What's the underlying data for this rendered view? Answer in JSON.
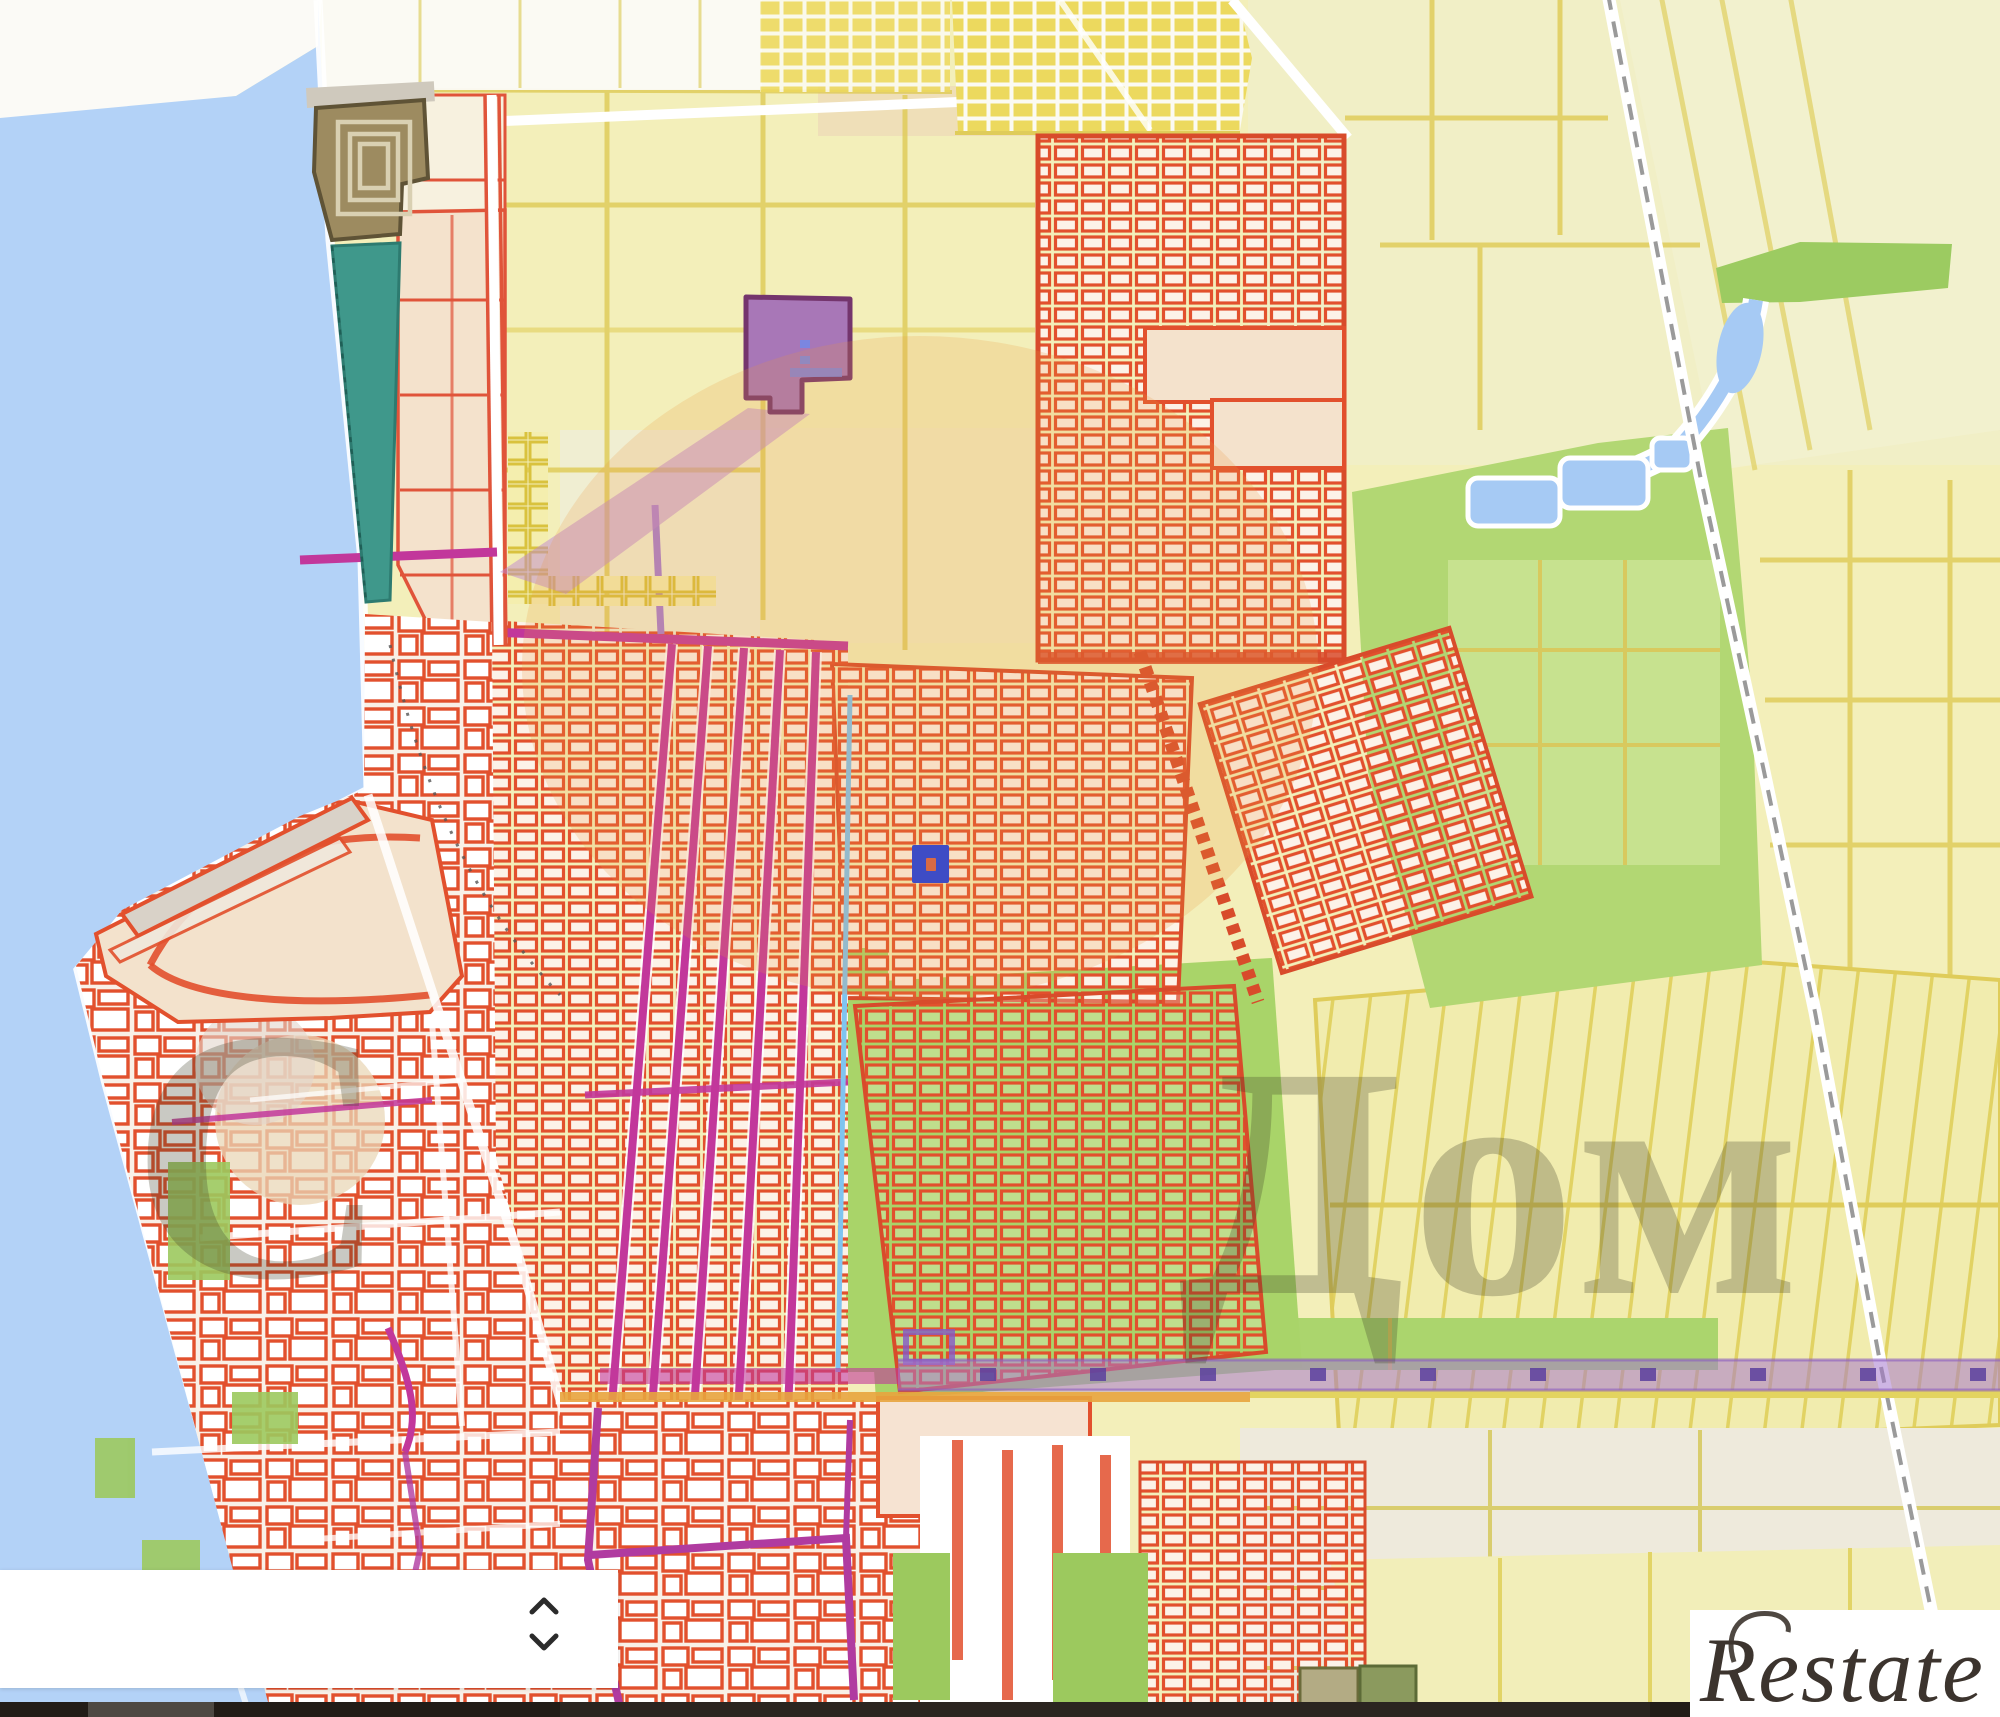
{
  "map": {
    "kind": "cadastral-parcel-map",
    "watermark": {
      "part_left": "С",
      "part_right": "Дом"
    },
    "marker": {
      "type": "selected-parcel-marker",
      "color": "#3e4cc5"
    },
    "colors": {
      "water": "#b3d2f7",
      "land": "#f3efba",
      "parcel_red": "#e2502d",
      "city_block_bg": "#f9f0e7",
      "road_magenta": "#c2379b",
      "road_purple": "#a678cd",
      "green": "#aed46e",
      "green_bright": "#9ccb61",
      "peach": "#f4e2cc",
      "teal": "#3f988b",
      "citadel": "#9d8b60",
      "purple_building": "#a877b7",
      "highlight_orange": "#ea963a",
      "yellow_parcel": "#ecd95e",
      "field_border": "#dfcc5a",
      "river_blue": "#a6caf4"
    }
  },
  "bottom_panel": {
    "collapsed": true
  },
  "icons": {
    "chevron_up": "chevron-up-icon",
    "chevron_down": "chevron-down-icon"
  },
  "logo": {
    "text": "Restate"
  }
}
